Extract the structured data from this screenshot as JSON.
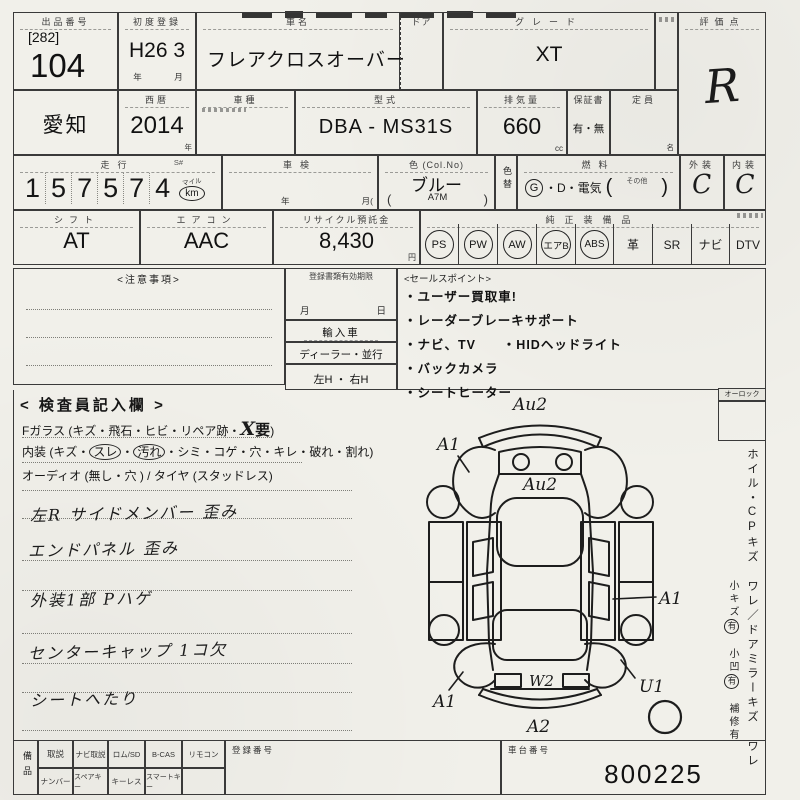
{
  "row1": {
    "lot_label": "出品番号",
    "lot_bracket": "[282]",
    "lot_number": "104",
    "first_reg_label": "初度登録",
    "first_reg_value": "H26 3",
    "first_reg_units": "年　月",
    "car_name_label": "車名",
    "car_name": "フレアクロスオーバー",
    "door_label": "ドア",
    "grade_label": "グレード",
    "grade": "XT",
    "score_label": "評価点",
    "score": "R"
  },
  "row2": {
    "region": "愛知",
    "year_label": "西暦",
    "year": "2014",
    "year_unit": "年",
    "model_label": "車種",
    "type_label": "型式",
    "type_value": "DBA - MS31S",
    "displacement_label": "排気量",
    "displacement": "660",
    "displacement_unit": "cc",
    "warranty_label": "保証書",
    "warranty": "有・無",
    "capacity_label": "定員",
    "capacity_unit": "名"
  },
  "row3": {
    "mileage_label": "走行",
    "mileage_s": "S#",
    "mileage_digits": [
      "1",
      "5",
      "7",
      "5",
      "7",
      "4"
    ],
    "mile_label": "マイル",
    "km_label": "km",
    "inspection_label": "車検",
    "inspection_year": "年",
    "inspection_month": "月(",
    "color_label": "色 (Col.No)",
    "color": "ブルー",
    "color_paren_open": "(",
    "color_no": "A7M",
    "color_paren_close": ")",
    "color_change_label": "色替",
    "fuel_label": "燃料",
    "fuel_g": "G",
    "fuel_rest": "・D・電気",
    "fuel_paren_open": "(",
    "fuel_other": "その他",
    "fuel_paren_close": ")",
    "exterior_label": "外装",
    "exterior_grade": "C",
    "interior_label": "内装",
    "interior_grade": "C"
  },
  "row4": {
    "shift_label": "シフト",
    "shift": "AT",
    "ac_label": "エアコン",
    "ac": "AAC",
    "recycle_label": "リサイクル預託金",
    "recycle": "8,430",
    "recycle_unit": "円",
    "equip_label": "純正装備品",
    "equipment": [
      {
        "label": "PS",
        "circled": true
      },
      {
        "label": "PW",
        "circled": true
      },
      {
        "label": "AW",
        "circled": true
      },
      {
        "label": "エアB",
        "circled": true
      },
      {
        "label": "ABS",
        "circled": true
      },
      {
        "label": "革",
        "circled": false
      },
      {
        "label": "SR",
        "circled": false
      },
      {
        "label": "ナビ",
        "circled": false
      },
      {
        "label": "DTV",
        "circled": false
      }
    ]
  },
  "notes": {
    "caution_label": "<注意事項>",
    "docs_label": "登録書類有効期限",
    "docs_month": "月",
    "docs_day": "日",
    "import_label": "輸入車",
    "dealer_label": "ディーラー・並行",
    "handle_label": "左H ・ 右H",
    "sales_label": "<セールスポイント>",
    "sales_points": [
      "・ユーザー買取車!",
      "・レーダーブレーキサポート",
      "・ナビ、TV      ・HIDヘッドライト",
      "・バックカメラ",
      "・シートヒーター"
    ]
  },
  "inspector": {
    "heading": "< 検査員記入欄 >",
    "glass_prefix": "Fガラス (キズ・飛石・ヒビ・リペア跡・",
    "glass_mark": "X",
    "glass_need": "要",
    "glass_suffix": ")",
    "interior_prefix": "内装 (キズ・",
    "interior_c1": "スレ",
    "interior_sep": "・",
    "interior_c2": "汚れ",
    "interior_suffix": "・シミ・コゲ・穴・キレ・破れ・割れ)",
    "audio_line": "オーディオ (無し・穴 ) / タイヤ (スタッドレス)",
    "hand_notes": [
      "左R サイドメンバー 歪み",
      "エンドパネル 歪み",
      "外装1部 Pハゲ",
      "センターキャップ 1コ欠",
      "シートへたり"
    ]
  },
  "diagram": {
    "marks": [
      {
        "label": "Au2",
        "part": "front-bumper"
      },
      {
        "label": "A1",
        "part": "front-left-fender"
      },
      {
        "label": "Au2",
        "part": "hood"
      },
      {
        "label": "A1",
        "part": "right-side-door"
      },
      {
        "label": "A1",
        "part": "rear-left-fender"
      },
      {
        "label": "U1",
        "part": "rear-right-fender"
      },
      {
        "label": "W2",
        "part": "rear-gate"
      },
      {
        "label": "A2",
        "part": "rear-bumper"
      }
    ]
  },
  "sidebar": {
    "lock_label": "オーロック",
    "wheel_text": "ホイル・CPキズ ワレ／ドアミラーキズ ワレ",
    "small_scratch": "小キズ",
    "small_scratch_yes": "有",
    "small_dent": "小凹",
    "small_dent_yes": "有",
    "repair": "補修有"
  },
  "bottom": {
    "items_label": "備品",
    "row_top": [
      "取説",
      "ナビ取説",
      "ロム/SD",
      "B-CAS",
      "リモコン"
    ],
    "row_bottom": [
      "ナンバー",
      "スペアキー",
      "キーレス",
      "スマートキー"
    ],
    "reg_no_label": "登録番号",
    "chassis_label": "車台番号",
    "chassis_no": "800225"
  }
}
